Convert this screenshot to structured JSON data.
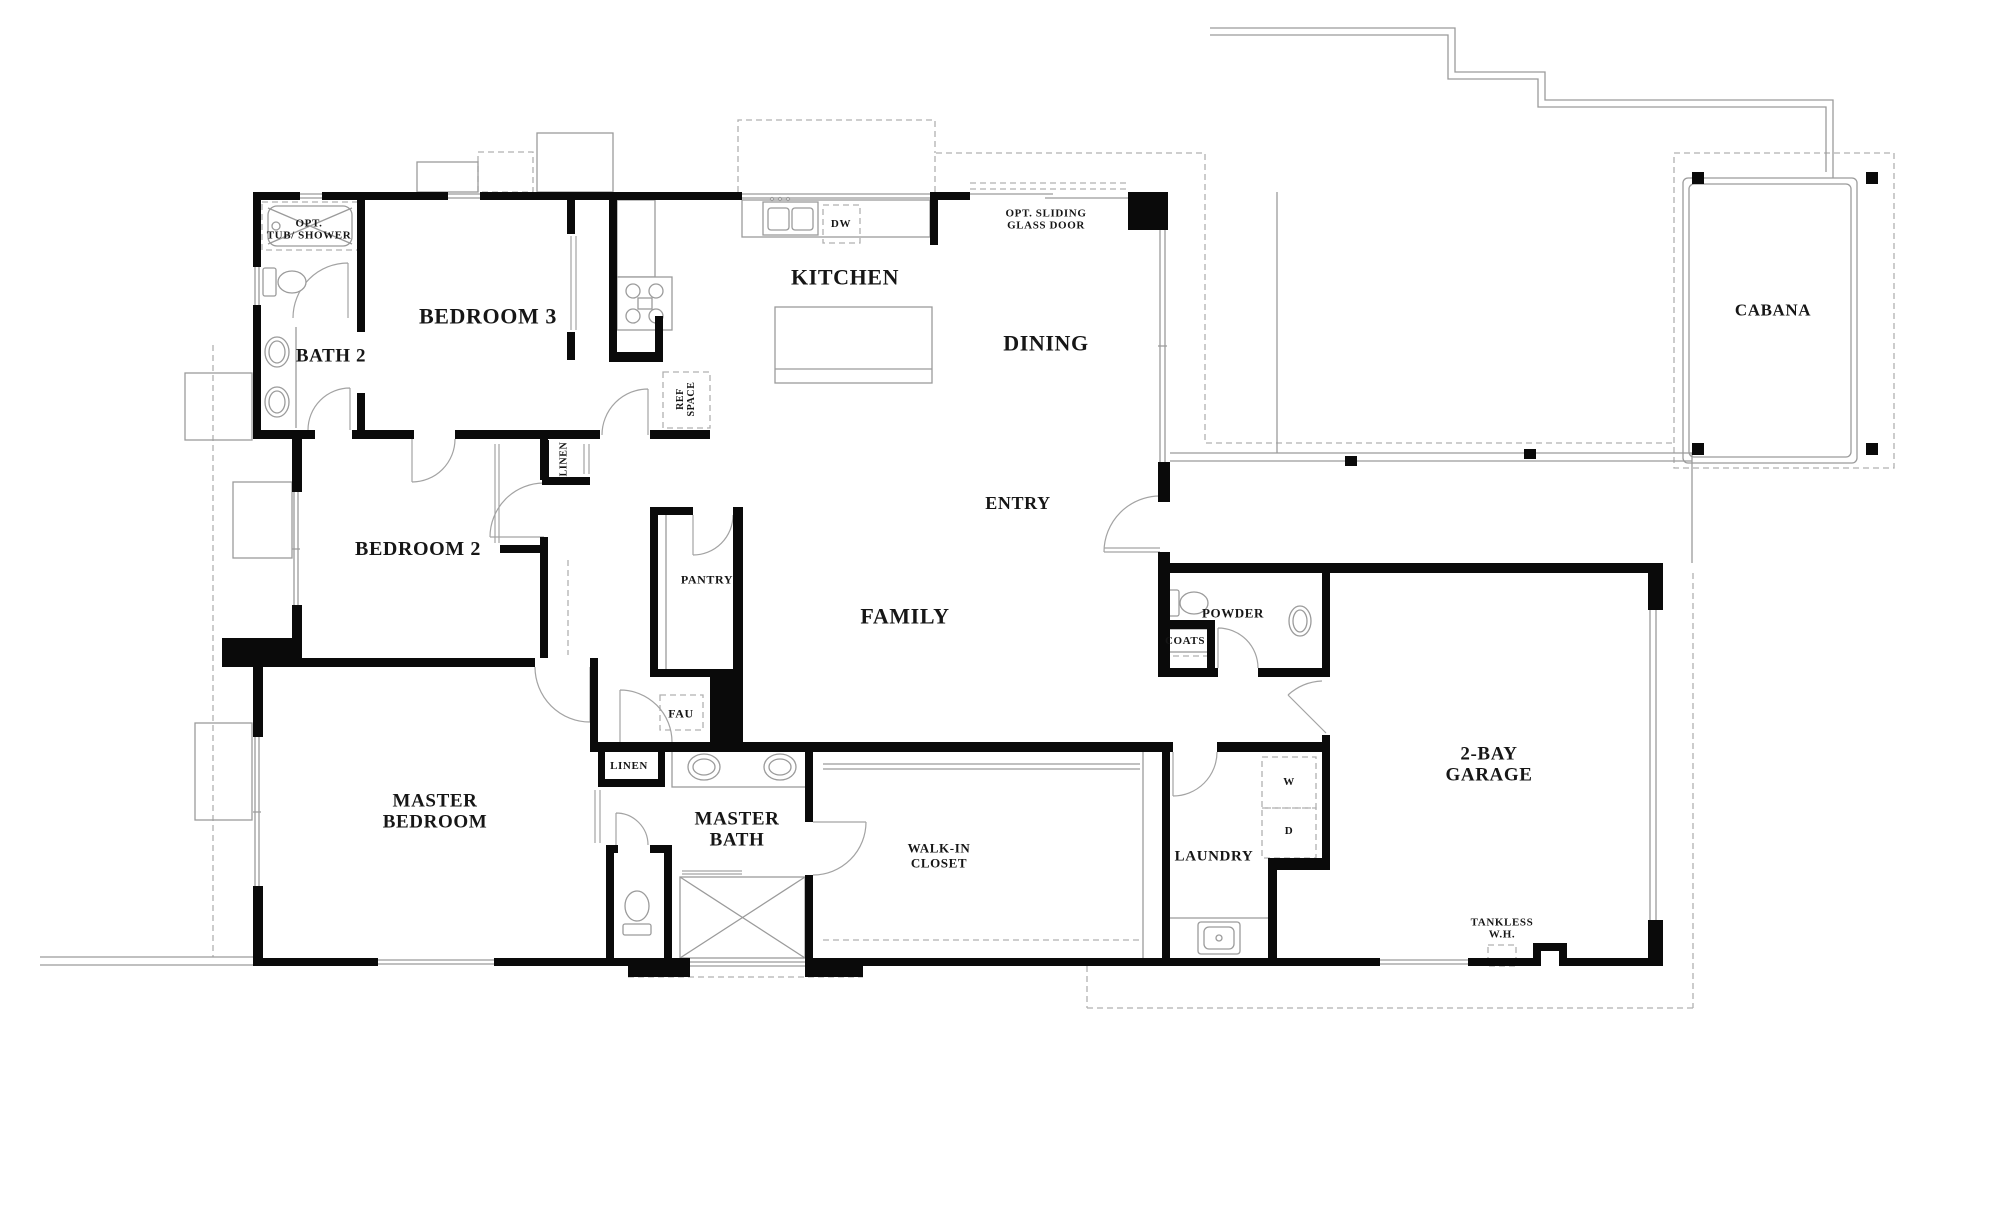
{
  "figure_type": "architectural-floor-plan",
  "colors": {
    "wall": "#0a0a0a",
    "fixture_line": "#9b9b9b",
    "dashed_line": "#b0b0b0",
    "text": "#161616",
    "background": "#ffffff"
  },
  "labels": [
    {
      "name": "opt-tub-shower",
      "lines": [
        "OPT.",
        "TUB/ SHOWER"
      ],
      "x": 309,
      "y": 230,
      "size": 11,
      "rot": 0
    },
    {
      "name": "bath-2",
      "lines": [
        "BATH 2"
      ],
      "x": 331,
      "y": 356,
      "size": 19,
      "rot": 0
    },
    {
      "name": "bedroom-3",
      "lines": [
        "BEDROOM 3"
      ],
      "x": 488,
      "y": 317,
      "size": 22,
      "rot": 0
    },
    {
      "name": "linen-hall",
      "lines": [
        "LINEN"
      ],
      "x": 564,
      "y": 459,
      "size": 10,
      "rot": 90
    },
    {
      "name": "ref-space",
      "lines": [
        "REF",
        "SPACE"
      ],
      "x": 686,
      "y": 399,
      "size": 10,
      "rot": 90
    },
    {
      "name": "kitchen",
      "lines": [
        "KITCHEN"
      ],
      "x": 845,
      "y": 278,
      "size": 22,
      "rot": 0
    },
    {
      "name": "dw",
      "lines": [
        "DW"
      ],
      "x": 841,
      "y": 224,
      "size": 11,
      "rot": 0
    },
    {
      "name": "opt-sliding-glass-door",
      "lines": [
        "OPT. SLIDING",
        "GLASS DOOR"
      ],
      "x": 1046,
      "y": 220,
      "size": 11,
      "rot": 0
    },
    {
      "name": "dining",
      "lines": [
        "DINING"
      ],
      "x": 1046,
      "y": 344,
      "size": 22,
      "rot": 0
    },
    {
      "name": "cabana",
      "lines": [
        "CABANA"
      ],
      "x": 1773,
      "y": 310,
      "size": 17,
      "rot": 0
    },
    {
      "name": "entry",
      "lines": [
        "ENTRY"
      ],
      "x": 1018,
      "y": 503,
      "size": 18,
      "rot": 0
    },
    {
      "name": "family",
      "lines": [
        "FAMILY"
      ],
      "x": 905,
      "y": 617,
      "size": 22,
      "rot": 0
    },
    {
      "name": "pantry",
      "lines": [
        "PANTRY"
      ],
      "x": 707,
      "y": 580,
      "size": 12,
      "rot": 0
    },
    {
      "name": "fau",
      "lines": [
        "FAU"
      ],
      "x": 681,
      "y": 714,
      "size": 12,
      "rot": 0
    },
    {
      "name": "linen-master",
      "lines": [
        "LINEN"
      ],
      "x": 629,
      "y": 766,
      "size": 11,
      "rot": 0
    },
    {
      "name": "master-bath",
      "lines": [
        "MASTER",
        "BATH"
      ],
      "x": 737,
      "y": 830,
      "size": 19,
      "rot": 0
    },
    {
      "name": "walk-in-closet",
      "lines": [
        "WALK-IN",
        "CLOSET"
      ],
      "x": 939,
      "y": 856,
      "size": 13,
      "rot": 0
    },
    {
      "name": "master-bedroom",
      "lines": [
        "MASTER",
        "BEDROOM"
      ],
      "x": 435,
      "y": 812,
      "size": 19,
      "rot": 0
    },
    {
      "name": "powder",
      "lines": [
        "POWDER"
      ],
      "x": 1233,
      "y": 614,
      "size": 13,
      "rot": 0
    },
    {
      "name": "coats",
      "lines": [
        "COATS"
      ],
      "x": 1185,
      "y": 641,
      "size": 11,
      "rot": 0
    },
    {
      "name": "laundry",
      "lines": [
        "LAUNDRY"
      ],
      "x": 1214,
      "y": 857,
      "size": 15,
      "rot": 0
    },
    {
      "name": "washer",
      "lines": [
        "W"
      ],
      "x": 1289,
      "y": 782,
      "size": 11,
      "rot": 0
    },
    {
      "name": "dryer",
      "lines": [
        "D"
      ],
      "x": 1289,
      "y": 831,
      "size": 11,
      "rot": 0
    },
    {
      "name": "two-bay-garage",
      "lines": [
        "2-BAY",
        "GARAGE"
      ],
      "x": 1489,
      "y": 765,
      "size": 19,
      "rot": 0
    },
    {
      "name": "tankless-wh",
      "lines": [
        "TANKLESS",
        "W.H."
      ],
      "x": 1502,
      "y": 929,
      "size": 11,
      "rot": 0
    },
    {
      "name": "bedroom-2",
      "lines": [
        "BEDROOM 2"
      ],
      "x": 418,
      "y": 549,
      "size": 20,
      "rot": 0
    }
  ]
}
